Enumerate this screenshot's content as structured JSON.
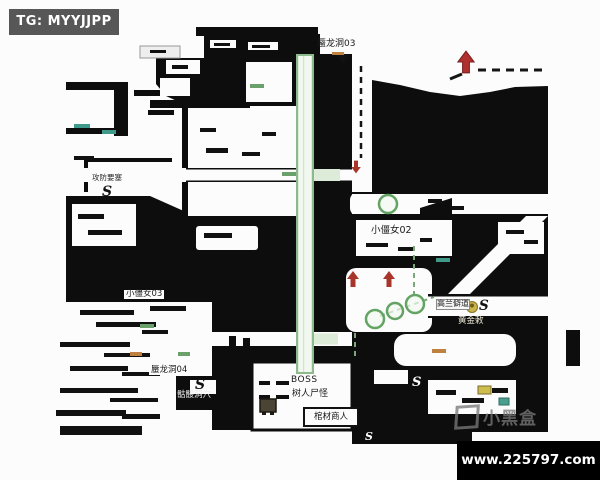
{
  "badges": {
    "tg": {
      "text": "TG: MYYJJPP",
      "bg": "#575757",
      "fg": "#ffffff"
    },
    "site": {
      "text": "www.225797.com",
      "bg": "#000000",
      "fg": "#ffffff"
    }
  },
  "watermark": {
    "text": "小黑盒"
  },
  "map_labels": {
    "shenlongdong03": "蜃龙洞03",
    "xiaojiangnv02": "小僵女02",
    "gongfangyaosai": "攻防要塞",
    "xiaojiangnv03": "小僵女03",
    "shenlongdong04": "蜃龙洞04",
    "kuloudongxue": "骷髅洞穴",
    "boss": "BOSS",
    "shurenshiguai": "树人尸怪",
    "guancaishangren": "棺材商人",
    "gaolanpidao": "高兰僻道",
    "huangjinchi": "黄金敕",
    "s_marker": "S"
  },
  "icons": {
    "red_up_arrow": "▲",
    "red_down_arrow": "▼",
    "green_circle_marker": "○",
    "yellow_head": "●",
    "yellow_item": "▬",
    "teal_item": "▬",
    "boss_statue": "■",
    "xiaoheihe_logo": "▣"
  },
  "colors": {
    "map_black": "#0d0d0d",
    "corridor_fill": "#f2f8f0",
    "corridor_edge": "#8cba8c",
    "path_green": "#7aa87a",
    "arrow_red": "#a8352a",
    "item_yellow": "#cdbd4e",
    "item_teal": "#49a08e",
    "badge_gray": "#575757"
  }
}
